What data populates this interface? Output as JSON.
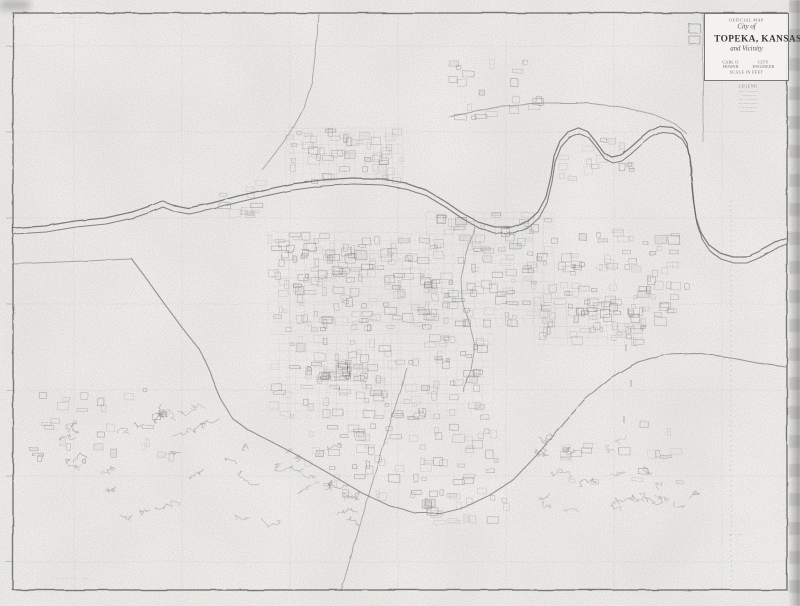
{
  "title_block": {
    "official": "OFFICIAL MAP",
    "city_of": "City of",
    "name": "TOPEKA, KANSAS",
    "vicinity": "and Vicinity",
    "left_credit": "CARL O. HOWER",
    "right_credit": "CITY ENGINEER",
    "scale_note": "SCALE IN FEET"
  },
  "legend": {
    "title": "LEGEND",
    "rows": [
      "—— ·———",
      "·· ————",
      "—·· ———",
      "— ————",
      "··— ———",
      "— ———"
    ]
  },
  "notes": {
    "top_left": "··––·  ·––··–",
    "bottom_left": "–··–– ––·· ––·",
    "bottom_right": "··––·––"
  },
  "map": {
    "width": 800,
    "height": 606,
    "seed": 42,
    "colors": {
      "paper": "#f3f2ef",
      "ink": "#4e4e4e",
      "road": "#757575",
      "river": "#565656",
      "faint": "#909090",
      "block": "#6e6e6e"
    },
    "border": {
      "x": 13,
      "y": 13,
      "w": 774,
      "h": 577
    },
    "grid": {
      "xs": [
        74,
        182,
        290,
        398,
        506,
        614,
        722
      ],
      "ys": [
        46,
        132,
        218,
        304,
        390,
        476,
        562
      ],
      "opacity": 0.15
    },
    "river": {
      "offset": 6,
      "bank": [
        [
          13,
          228
        ],
        [
          45,
          226
        ],
        [
          75,
          221
        ],
        [
          105,
          218
        ],
        [
          132,
          212
        ],
        [
          150,
          206
        ],
        [
          162,
          201
        ],
        [
          172,
          205
        ],
        [
          188,
          208
        ],
        [
          212,
          203
        ],
        [
          238,
          196
        ],
        [
          264,
          190
        ],
        [
          292,
          184
        ],
        [
          322,
          180
        ],
        [
          352,
          178
        ],
        [
          382,
          179
        ],
        [
          406,
          183
        ],
        [
          426,
          190
        ],
        [
          446,
          202
        ],
        [
          462,
          213
        ],
        [
          478,
          222
        ],
        [
          495,
          227
        ],
        [
          512,
          227
        ],
        [
          528,
          221
        ],
        [
          538,
          212
        ],
        [
          546,
          197
        ],
        [
          551,
          176
        ],
        [
          554,
          156
        ],
        [
          560,
          141
        ],
        [
          568,
          132
        ],
        [
          578,
          128
        ],
        [
          588,
          132
        ],
        [
          596,
          142
        ],
        [
          604,
          153
        ],
        [
          612,
          157
        ],
        [
          621,
          155
        ],
        [
          630,
          148
        ],
        [
          640,
          139
        ],
        [
          650,
          131
        ],
        [
          661,
          126
        ],
        [
          672,
          127
        ],
        [
          681,
          133
        ],
        [
          687,
          143
        ],
        [
          690,
          157
        ],
        [
          691,
          176
        ],
        [
          693,
          198
        ],
        [
          696,
          218
        ],
        [
          701,
          233
        ],
        [
          709,
          245
        ],
        [
          720,
          253
        ],
        [
          733,
          257
        ],
        [
          746,
          257
        ],
        [
          758,
          252
        ],
        [
          769,
          246
        ],
        [
          778,
          241
        ],
        [
          786,
          238
        ]
      ]
    },
    "highway": [
      [
        131,
        258
      ],
      [
        148,
        281
      ],
      [
        166,
        306
      ],
      [
        184,
        330
      ],
      [
        200,
        350
      ],
      [
        210,
        372
      ],
      [
        220,
        398
      ],
      [
        232,
        418
      ],
      [
        248,
        430
      ],
      [
        268,
        440
      ],
      [
        295,
        454
      ],
      [
        330,
        474
      ],
      [
        362,
        493
      ],
      [
        390,
        506
      ],
      [
        415,
        513
      ],
      [
        440,
        513
      ],
      [
        465,
        507
      ],
      [
        490,
        495
      ],
      [
        513,
        480
      ],
      [
        536,
        456
      ],
      [
        560,
        428
      ],
      [
        584,
        400
      ],
      [
        610,
        378
      ],
      [
        638,
        362
      ],
      [
        666,
        354
      ],
      [
        697,
        353
      ],
      [
        727,
        357
      ],
      [
        757,
        363
      ],
      [
        786,
        367
      ]
    ],
    "roads": [
      {
        "name": "north-road",
        "points": [
          [
            319,
            14
          ],
          [
            316,
            48
          ],
          [
            312,
            82
          ],
          [
            304,
            108
          ],
          [
            291,
            132
          ],
          [
            276,
            152
          ],
          [
            262,
            170
          ]
        ]
      },
      {
        "name": "river-road-arc",
        "points": [
          [
            448,
            117
          ],
          [
            498,
            107
          ],
          [
            544,
            103
          ],
          [
            586,
            103
          ],
          [
            622,
            107
          ],
          [
            652,
            114
          ],
          [
            674,
            123
          ],
          [
            687,
            134
          ]
        ]
      },
      {
        "name": "west-road",
        "points": [
          [
            13,
            264
          ],
          [
            131,
            259
          ]
        ]
      },
      {
        "name": "south-diagonal",
        "points": [
          [
            341,
            591
          ],
          [
            376,
            470
          ],
          [
            407,
            368
          ]
        ]
      },
      {
        "name": "creek",
        "points": [
          [
            475,
            227
          ],
          [
            467,
            252
          ],
          [
            461,
            278
          ],
          [
            462,
            300
          ],
          [
            469,
            322
          ],
          [
            475,
            346
          ],
          [
            471,
            370
          ],
          [
            463,
            392
          ]
        ]
      },
      {
        "name": "county-line",
        "points": [
          [
            731,
            200
          ],
          [
            731,
            588
          ]
        ],
        "dash": "1.5 3.5",
        "opacity": 0.28
      },
      {
        "name": "inset-divider",
        "points": [
          [
            703,
            13
          ],
          [
            703,
            142
          ]
        ],
        "opacity": 0.5
      }
    ],
    "extra_rects": [
      [
        689,
        24,
        11,
        9
      ],
      [
        689,
        36,
        11,
        8
      ]
    ],
    "block_regions": [
      {
        "x": 286,
        "y": 128,
        "w": 118,
        "h": 56,
        "n": 50,
        "streets": true
      },
      {
        "x": 268,
        "y": 232,
        "w": 168,
        "h": 100,
        "n": 150,
        "streets": true
      },
      {
        "x": 426,
        "y": 212,
        "w": 128,
        "h": 116,
        "n": 110,
        "streets": true
      },
      {
        "x": 268,
        "y": 334,
        "w": 226,
        "h": 86,
        "n": 110,
        "streets": true
      },
      {
        "x": 300,
        "y": 422,
        "w": 205,
        "h": 82,
        "n": 70,
        "streets": false
      },
      {
        "x": 546,
        "y": 228,
        "w": 134,
        "h": 100,
        "n": 70,
        "streets": false
      },
      {
        "x": 534,
        "y": 298,
        "w": 114,
        "h": 48,
        "n": 45,
        "streets": true
      },
      {
        "x": 28,
        "y": 388,
        "w": 155,
        "h": 78,
        "n": 30,
        "streets": false
      },
      {
        "x": 560,
        "y": 420,
        "w": 125,
        "h": 65,
        "n": 20,
        "streets": false
      },
      {
        "x": 418,
        "y": 498,
        "w": 92,
        "h": 28,
        "n": 16,
        "streets": false
      },
      {
        "x": 430,
        "y": 58,
        "w": 115,
        "h": 62,
        "n": 20,
        "streets": false
      },
      {
        "x": 316,
        "y": 364,
        "w": 44,
        "h": 18,
        "n": 20,
        "streets": true
      },
      {
        "x": 555,
        "y": 130,
        "w": 85,
        "h": 52,
        "n": 16,
        "streets": false
      },
      {
        "x": 205,
        "y": 178,
        "w": 62,
        "h": 42,
        "n": 12,
        "streets": false
      },
      {
        "x": 640,
        "y": 250,
        "w": 55,
        "h": 60,
        "n": 8,
        "streets": false
      }
    ],
    "squiggle_regions": [
      {
        "x": 55,
        "y": 398,
        "w": 150,
        "h": 118,
        "n": 24
      },
      {
        "x": 222,
        "y": 428,
        "w": 125,
        "h": 92,
        "n": 18
      },
      {
        "x": 533,
        "y": 430,
        "w": 105,
        "h": 85,
        "n": 14
      },
      {
        "x": 612,
        "y": 470,
        "w": 80,
        "h": 60,
        "n": 8
      }
    ],
    "ticks": [
      [
        628,
        308
      ],
      [
        626,
        344
      ],
      [
        631,
        380
      ],
      [
        624,
        416
      ]
    ],
    "noise": {
      "fine_frequency": 0.9,
      "fine_seed": 7,
      "fine_opacity": 0.5,
      "coarse_frequency": 0.012,
      "coarse_seed": 3,
      "coarse_opacity": 0.1,
      "rough_scale": 1.8
    }
  }
}
